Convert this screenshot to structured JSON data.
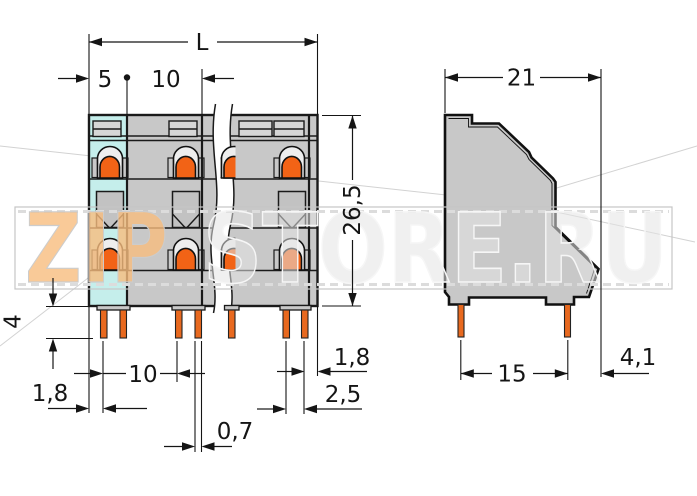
{
  "drawing": {
    "type": "terminal-block dimensional drawing",
    "front_view": {
      "dim_length": "L",
      "dim_end_offset": "5",
      "dim_pitch": "10",
      "dim_height": "26,5",
      "dim_pin_length": "4",
      "dim_left_margin": "1,8",
      "dim_pin_row_pitch": "10",
      "dim_pin_width": "0,7",
      "dim_right_margin": "1,8",
      "dim_pin_gap": "2,5"
    },
    "side_view": {
      "dim_depth": "21",
      "dim_pin_spacing": "15",
      "dim_back_offset": "4,1"
    }
  },
  "watermark": {
    "zip": "ZIP",
    "store": "STORE.RU"
  },
  "colors": {
    "body_gray": "#c8c8c8",
    "highlight_cyan": "#c5eeeb",
    "actuator_orange": "#f26316",
    "pin_orange": "#e8691f",
    "line_black": "#151515",
    "watermark_orange": "#f7bd7e",
    "watermark_gray": "#e3e3e3"
  }
}
